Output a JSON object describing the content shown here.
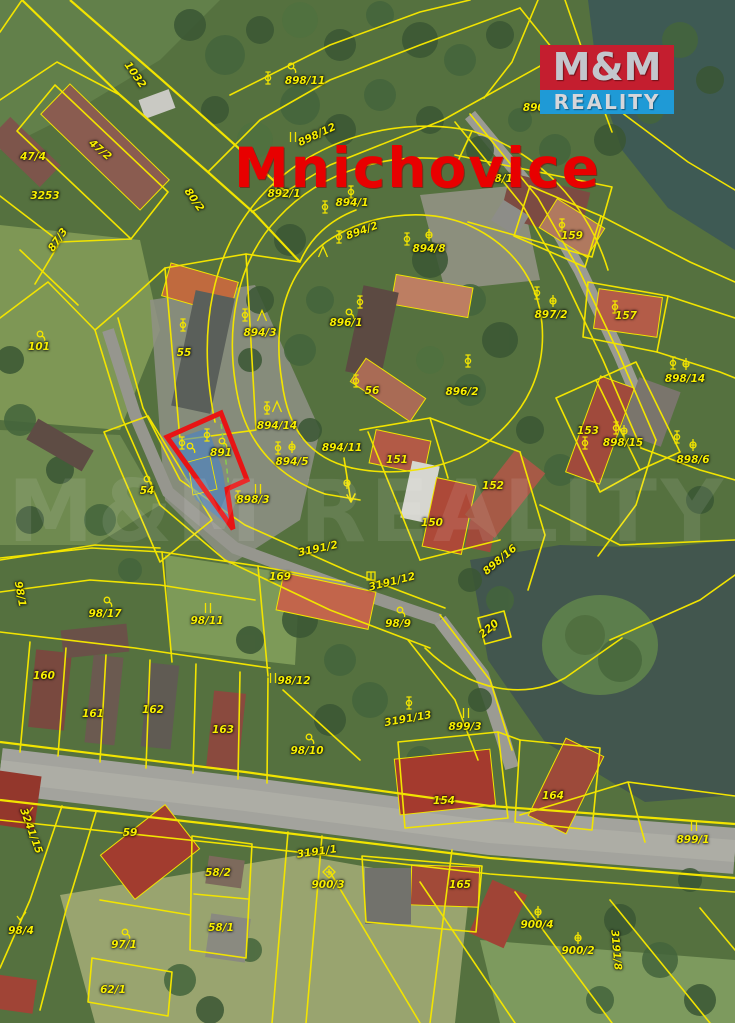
{
  "map": {
    "title": "Mnichovice",
    "watermark": "M&M REALITY",
    "logo": {
      "line1": "M&M",
      "line2": "REALITY"
    },
    "highlighted_parcel": "891",
    "colors": {
      "parcel_line": "#f2e400",
      "label": "#f8ef00",
      "highlight_outline": "#e81414",
      "highlight_fill": "rgba(64,130,210,0.55)",
      "title": "#e80000",
      "logo_red": "#c41e2f",
      "logo_blue": "#1f9ad6",
      "logo_text": "#c3c6cc",
      "water": "#42564e",
      "road": "#a3a39d"
    },
    "parcel_labels": [
      {
        "text": "1032",
        "x": 135,
        "y": 75,
        "rot": 55
      },
      {
        "text": "47/4",
        "x": 33,
        "y": 157,
        "rot": 0
      },
      {
        "text": "47/2",
        "x": 100,
        "y": 150,
        "rot": 40
      },
      {
        "text": "3253",
        "x": 45,
        "y": 196,
        "rot": 0
      },
      {
        "text": "87/3",
        "x": 58,
        "y": 240,
        "rot": -55
      },
      {
        "text": "80/2",
        "x": 194,
        "y": 200,
        "rot": 55
      },
      {
        "text": "898/11",
        "x": 305,
        "y": 81,
        "rot": 0
      },
      {
        "text": "898/12",
        "x": 317,
        "y": 135,
        "rot": -25
      },
      {
        "text": "890/17",
        "x": 543,
        "y": 108,
        "rot": 0
      },
      {
        "text": "892/1",
        "x": 284,
        "y": 194,
        "rot": 0
      },
      {
        "text": "894/1",
        "x": 352,
        "y": 203,
        "rot": 0
      },
      {
        "text": "894/2",
        "x": 362,
        "y": 231,
        "rot": -20
      },
      {
        "text": "894/8",
        "x": 429,
        "y": 249,
        "rot": 0
      },
      {
        "text": "98/1",
        "x": 500,
        "y": 179,
        "rot": 0
      },
      {
        "text": "159",
        "x": 572,
        "y": 236,
        "rot": 0
      },
      {
        "text": "897/2",
        "x": 551,
        "y": 315,
        "rot": 0
      },
      {
        "text": "157",
        "x": 626,
        "y": 316,
        "rot": 0
      },
      {
        "text": "898/14",
        "x": 685,
        "y": 379,
        "rot": 0
      },
      {
        "text": "896/1",
        "x": 346,
        "y": 323,
        "rot": 0
      },
      {
        "text": "55",
        "x": 184,
        "y": 353,
        "rot": 0
      },
      {
        "text": "101",
        "x": 39,
        "y": 347,
        "rot": 0
      },
      {
        "text": "894/3",
        "x": 260,
        "y": 333,
        "rot": 0
      },
      {
        "text": "56",
        "x": 372,
        "y": 391,
        "rot": 0
      },
      {
        "text": "896/2",
        "x": 462,
        "y": 392,
        "rot": 0
      },
      {
        "text": "894/14",
        "x": 277,
        "y": 426,
        "rot": 0
      },
      {
        "text": "894/11",
        "x": 342,
        "y": 448,
        "rot": 0
      },
      {
        "text": "891",
        "x": 221,
        "y": 453,
        "rot": 0
      },
      {
        "text": "894/5",
        "x": 292,
        "y": 462,
        "rot": 0
      },
      {
        "text": "151",
        "x": 397,
        "y": 460,
        "rot": 0
      },
      {
        "text": "898/3",
        "x": 253,
        "y": 500,
        "rot": 0
      },
      {
        "text": "54",
        "x": 147,
        "y": 491,
        "rot": 0
      },
      {
        "text": "153",
        "x": 588,
        "y": 431,
        "rot": 0
      },
      {
        "text": "898/15",
        "x": 623,
        "y": 443,
        "rot": 0
      },
      {
        "text": "898/6",
        "x": 693,
        "y": 460,
        "rot": 0
      },
      {
        "text": "152",
        "x": 493,
        "y": 486,
        "rot": 0
      },
      {
        "text": "150",
        "x": 432,
        "y": 523,
        "rot": 0
      },
      {
        "text": "898/16",
        "x": 500,
        "y": 560,
        "rot": -40
      },
      {
        "text": "3191/2",
        "x": 318,
        "y": 549,
        "rot": -12
      },
      {
        "text": "169",
        "x": 280,
        "y": 577,
        "rot": 0
      },
      {
        "text": "3191/12",
        "x": 392,
        "y": 582,
        "rot": -14
      },
      {
        "text": "98/9",
        "x": 398,
        "y": 624,
        "rot": 0
      },
      {
        "text": "220",
        "x": 489,
        "y": 629,
        "rot": -40
      },
      {
        "text": "98/17",
        "x": 105,
        "y": 614,
        "rot": 0
      },
      {
        "text": "98/11",
        "x": 207,
        "y": 621,
        "rot": 0
      },
      {
        "text": "98/1",
        "x": 20,
        "y": 594,
        "rot": 80
      },
      {
        "text": "160",
        "x": 44,
        "y": 676,
        "rot": 0
      },
      {
        "text": "161",
        "x": 93,
        "y": 714,
        "rot": 0
      },
      {
        "text": "162",
        "x": 153,
        "y": 710,
        "rot": 0
      },
      {
        "text": "163",
        "x": 223,
        "y": 730,
        "rot": 0
      },
      {
        "text": "98/12",
        "x": 294,
        "y": 681,
        "rot": 0
      },
      {
        "text": "98/10",
        "x": 307,
        "y": 751,
        "rot": 0
      },
      {
        "text": "3191/13",
        "x": 408,
        "y": 719,
        "rot": -10
      },
      {
        "text": "899/3",
        "x": 465,
        "y": 727,
        "rot": 0
      },
      {
        "text": "154",
        "x": 444,
        "y": 801,
        "rot": 0
      },
      {
        "text": "164",
        "x": 553,
        "y": 796,
        "rot": 0
      },
      {
        "text": "899/1",
        "x": 693,
        "y": 840,
        "rot": 0
      },
      {
        "text": "59",
        "x": 130,
        "y": 833,
        "rot": 0
      },
      {
        "text": "3241/15",
        "x": 31,
        "y": 831,
        "rot": 70
      },
      {
        "text": "98/4",
        "x": 21,
        "y": 931,
        "rot": 0
      },
      {
        "text": "97/1",
        "x": 124,
        "y": 945,
        "rot": 0
      },
      {
        "text": "62/1",
        "x": 113,
        "y": 990,
        "rot": 0
      },
      {
        "text": "58/2",
        "x": 218,
        "y": 873,
        "rot": 0
      },
      {
        "text": "58/1",
        "x": 221,
        "y": 928,
        "rot": 0
      },
      {
        "text": "3191/1",
        "x": 317,
        "y": 852,
        "rot": -8
      },
      {
        "text": "900/3",
        "x": 328,
        "y": 885,
        "rot": 0
      },
      {
        "text": "165",
        "x": 460,
        "y": 885,
        "rot": 0
      },
      {
        "text": "900/4",
        "x": 537,
        "y": 925,
        "rot": 0
      },
      {
        "text": "900/2",
        "x": 578,
        "y": 951,
        "rot": 0
      },
      {
        "text": "3191/8",
        "x": 616,
        "y": 950,
        "rot": 85
      }
    ],
    "symbols": [
      {
        "t": "tree",
        "x": 268,
        "y": 78
      },
      {
        "t": "scrub",
        "x": 291,
        "y": 67
      },
      {
        "t": "bars",
        "x": 293,
        "y": 137
      },
      {
        "t": "tree",
        "x": 276,
        "y": 184
      },
      {
        "t": "tree",
        "x": 351,
        "y": 192
      },
      {
        "t": "tree",
        "x": 325,
        "y": 207
      },
      {
        "t": "tree",
        "x": 339,
        "y": 237
      },
      {
        "t": "lambda",
        "x": 323,
        "y": 252
      },
      {
        "t": "tree",
        "x": 407,
        "y": 239
      },
      {
        "t": "cross",
        "x": 429,
        "y": 235
      },
      {
        "t": "tree",
        "x": 183,
        "y": 325
      },
      {
        "t": "tree",
        "x": 356,
        "y": 381
      },
      {
        "t": "tree",
        "x": 360,
        "y": 302
      },
      {
        "t": "scrub",
        "x": 349,
        "y": 313
      },
      {
        "t": "tree",
        "x": 468,
        "y": 361
      },
      {
        "t": "tree",
        "x": 537,
        "y": 293
      },
      {
        "t": "cross",
        "x": 553,
        "y": 301
      },
      {
        "t": "tree",
        "x": 562,
        "y": 225
      },
      {
        "t": "tree",
        "x": 615,
        "y": 307
      },
      {
        "t": "tree",
        "x": 677,
        "y": 437
      },
      {
        "t": "cross",
        "x": 693,
        "y": 445
      },
      {
        "t": "tree",
        "x": 673,
        "y": 363
      },
      {
        "t": "cross",
        "x": 686,
        "y": 364
      },
      {
        "t": "tree",
        "x": 616,
        "y": 428
      },
      {
        "t": "cross",
        "x": 624,
        "y": 431
      },
      {
        "t": "tree",
        "x": 585,
        "y": 443
      },
      {
        "t": "tree",
        "x": 245,
        "y": 315
      },
      {
        "t": "lambda",
        "x": 262,
        "y": 316
      },
      {
        "t": "tree",
        "x": 267,
        "y": 408
      },
      {
        "t": "lambda",
        "x": 277,
        "y": 407
      },
      {
        "t": "tree",
        "x": 278,
        "y": 448
      },
      {
        "t": "cross",
        "x": 292,
        "y": 447
      },
      {
        "t": "cross",
        "x": 347,
        "y": 483
      },
      {
        "t": "tree",
        "x": 207,
        "y": 435
      },
      {
        "t": "scrub",
        "x": 222,
        "y": 442
      },
      {
        "t": "tree",
        "x": 182,
        "y": 443
      },
      {
        "t": "scrub",
        "x": 190,
        "y": 447
      },
      {
        "t": "bars",
        "x": 258,
        "y": 489
      },
      {
        "t": "tree",
        "x": 238,
        "y": 497
      },
      {
        "t": "scrub",
        "x": 147,
        "y": 480
      },
      {
        "t": "scrub",
        "x": 40,
        "y": 335
      },
      {
        "t": "scrub",
        "x": 107,
        "y": 601
      },
      {
        "t": "bars",
        "x": 208,
        "y": 608
      },
      {
        "t": "bars",
        "x": 273,
        "y": 678
      },
      {
        "t": "scrub",
        "x": 309,
        "y": 738
      },
      {
        "t": "scrub",
        "x": 400,
        "y": 611
      },
      {
        "t": "tree",
        "x": 409,
        "y": 703
      },
      {
        "t": "boxcross",
        "x": 371,
        "y": 576
      },
      {
        "t": "bars",
        "x": 466,
        "y": 713
      },
      {
        "t": "bars",
        "x": 694,
        "y": 826
      },
      {
        "t": "cross",
        "x": 538,
        "y": 912
      },
      {
        "t": "cross",
        "x": 578,
        "y": 938
      },
      {
        "t": "dcross",
        "x": 329,
        "y": 872
      },
      {
        "t": "scrub",
        "x": 125,
        "y": 933
      },
      {
        "t": "check",
        "x": 28,
        "y": 812
      },
      {
        "t": "check",
        "x": 21,
        "y": 917
      },
      {
        "t": "dot",
        "x": 494,
        "y": 629
      }
    ]
  }
}
